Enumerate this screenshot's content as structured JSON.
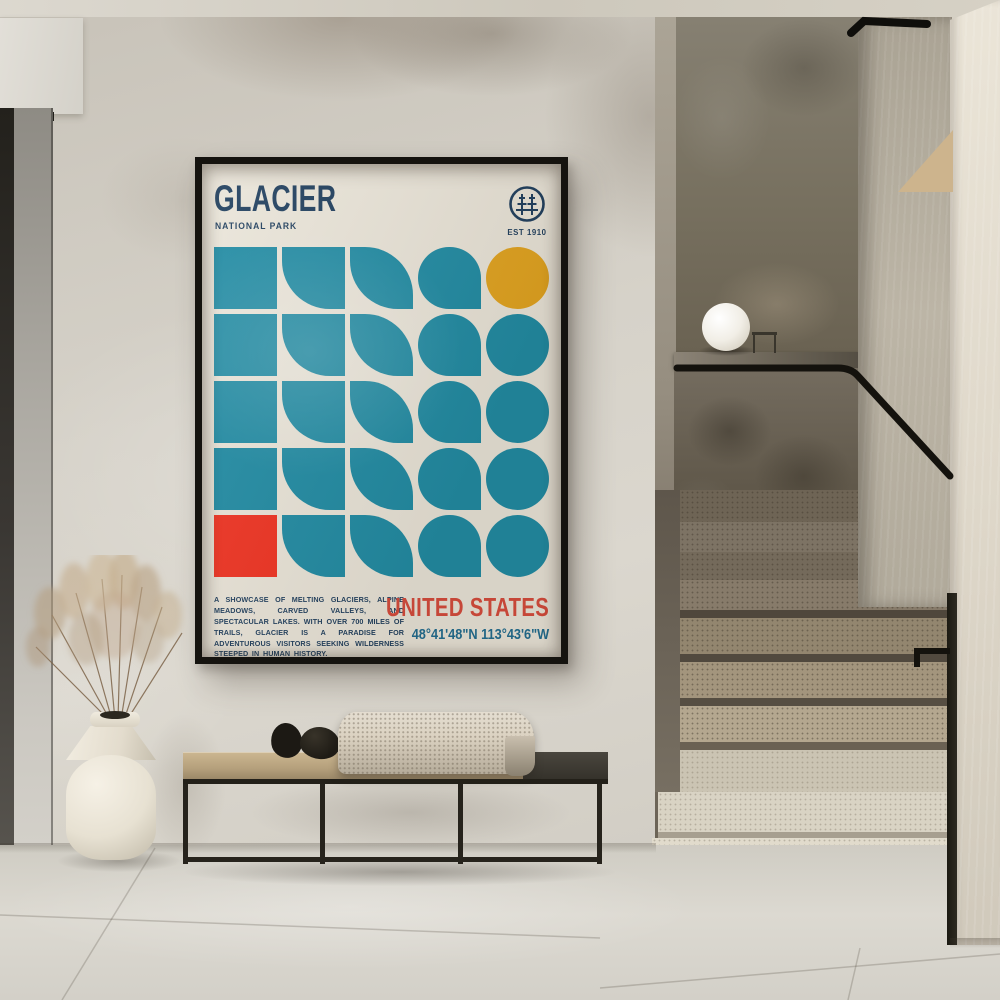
{
  "poster": {
    "title": "GLACIER",
    "subtitle": "NATIONAL PARK",
    "established": "EST 1910",
    "logo_icon": "pine-trees-in-circle",
    "description": "A SHOWCASE OF MELTING GLACIERS, ALPINE MEADOWS, CARVED VALLEYS, AND SPECTACULAR LAKES. WITH OVER 700 MILES OF TRAILS, GLACIER IS A PARADISE FOR ADVENTUROUS VISITORS SEEKING WILDERNESS STEEPED IN HUMAN HISTORY.",
    "country": "UNITED STATES",
    "coordinates": "48°41'48\"N 113°43'6\"W",
    "colors": {
      "teal": "#1d8aa3",
      "yellow": "#e2a31d",
      "red": "#f0301f",
      "navy": "#1c3c5c",
      "country_red": "#d6493a",
      "coord_blue": "#1e6b8f",
      "background": "#eae5d9",
      "frame": "#15130f"
    },
    "grid": {
      "rows": 5,
      "cols": 5,
      "cells": [
        {
          "shape": "square",
          "color": "teal"
        },
        {
          "shape": "round-bl",
          "color": "teal"
        },
        {
          "shape": "leaf",
          "color": "teal"
        },
        {
          "shape": "drop",
          "color": "teal"
        },
        {
          "shape": "circle",
          "color": "yellow"
        },
        {
          "shape": "square",
          "color": "teal"
        },
        {
          "shape": "round-bl",
          "color": "teal"
        },
        {
          "shape": "leaf",
          "color": "teal"
        },
        {
          "shape": "drop",
          "color": "teal"
        },
        {
          "shape": "circle",
          "color": "teal"
        },
        {
          "shape": "square",
          "color": "teal"
        },
        {
          "shape": "round-bl",
          "color": "teal"
        },
        {
          "shape": "leaf",
          "color": "teal"
        },
        {
          "shape": "drop",
          "color": "teal"
        },
        {
          "shape": "circle",
          "color": "teal"
        },
        {
          "shape": "square",
          "color": "teal"
        },
        {
          "shape": "round-bl",
          "color": "teal"
        },
        {
          "shape": "leaf",
          "color": "teal"
        },
        {
          "shape": "drop",
          "color": "teal"
        },
        {
          "shape": "circle",
          "color": "teal"
        },
        {
          "shape": "square",
          "color": "red"
        },
        {
          "shape": "round-bl",
          "color": "teal"
        },
        {
          "shape": "leaf",
          "color": "teal"
        },
        {
          "shape": "drop",
          "color": "teal"
        },
        {
          "shape": "circle",
          "color": "teal"
        }
      ]
    }
  }
}
